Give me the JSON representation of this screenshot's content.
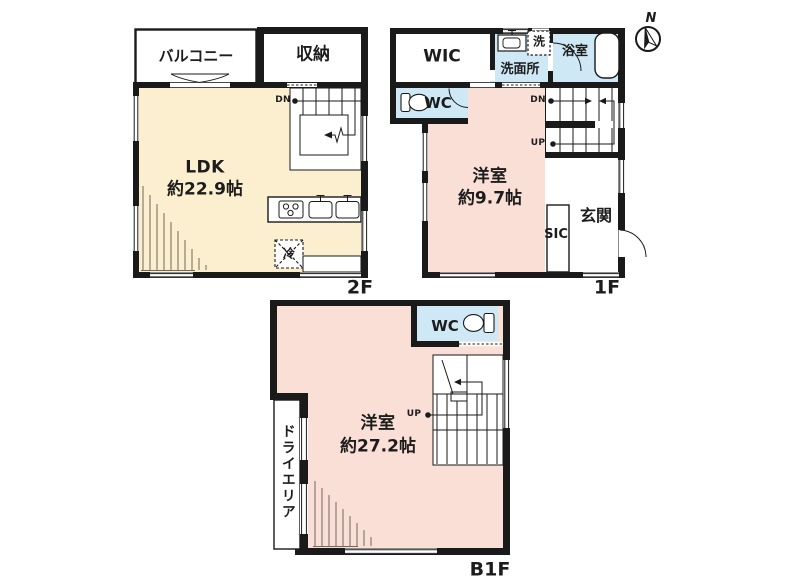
{
  "colors": {
    "wall": "#1a1a1a",
    "ldk_fill": "#fcefd0",
    "room_fill": "#fadfd7",
    "wet_fill": "#cee9f5"
  },
  "compass": {
    "north_label": "N"
  },
  "f2": {
    "floor_label": "2F",
    "balcony": "バルコニー",
    "storage": "収納",
    "room_name": "LDK",
    "room_size": "約22.9帖",
    "stairs_dn": "DN",
    "fridge": "冷"
  },
  "f1": {
    "floor_label": "1F",
    "wic": "WIC",
    "washroom": "洗面所",
    "laundry": "洗",
    "bathroom": "浴室",
    "wc": "WC",
    "room_name": "洋室",
    "room_size": "約9.7帖",
    "sic": "SIC",
    "entrance": "玄関",
    "stairs_dn": "DN",
    "stairs_up": "UP"
  },
  "b1f": {
    "floor_label": "B1F",
    "wc": "WC",
    "room_name": "洋室",
    "room_size": "約27.2帖",
    "dry_area": "ドライエリア",
    "stairs_up": "UP"
  }
}
